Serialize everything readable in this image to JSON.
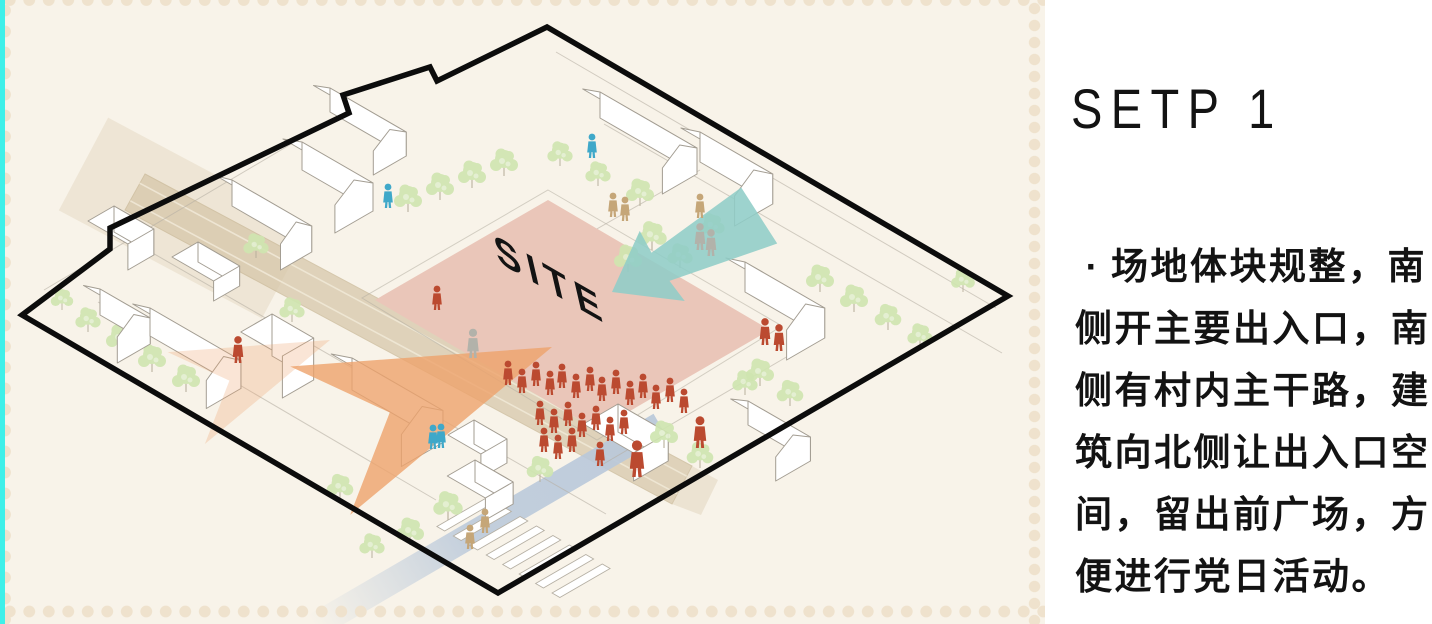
{
  "colors": {
    "cyan-strip": "#3ff0e9",
    "panel-cream": "#f8f3e9",
    "dot": "#efe2cd",
    "ink": "#131313",
    "boundary-black": "#0c0c0c",
    "site-pink": "#eac6b9",
    "arrow-teal": "#8fcdc7",
    "arrow-orange": "#eda26b",
    "road-tan": "#d6c6a8",
    "road-blue": "#b9c8da",
    "tree-green": "#cfe5b0",
    "building-line": "#a39d92",
    "street-line": "#b5afa3",
    "person-red": "#bb4a30",
    "person-blue": "#3fa8c9",
    "person-tan": "#c5a678",
    "person-gray": "#b2b2aa"
  },
  "step_panel": {
    "title": "SETP 1",
    "bullet": "·",
    "lines": [
      "场地体块规整，南",
      "侧开主要出入口，南",
      "侧有村内主干路，建",
      "筑向北侧让出入口空",
      "间，留出前广场，方",
      "便进行党日活动。"
    ]
  },
  "illustration": {
    "site_label": "SITE",
    "site_label_transform": "matrix(0.87,0.5,0.22,0.95,498,262)",
    "boundary": "547,27 1008,296 498,593 22,315 110,249 110,228 349,113 343,95 430,67 437,81",
    "site_block": "548,200 770,330 597,430 375,300",
    "sidewalk": "548,190 782,326 597,440 362,298",
    "roads": {
      "tan_band": "145,174 692,466 672,504 125,210",
      "tan_head": {
        "x": 185,
        "y": 218,
        "w": 230,
        "h": 105,
        "rot": 28
      },
      "tan_exit": "692,466 718,480 701,515 672,504",
      "lanes": [
        [
          139.7,
          183.2,
          686.7,
          476.2
        ],
        [
          130.3,
          200.8,
          677.3,
          493.8
        ]
      ],
      "blue_band": "653.5,413.8 666.5,436.2 320.9,637.4 307.9,615",
      "blue_grad": {
        "x1": 660,
        "y1": 425,
        "x2": 314,
        "y2": 626
      }
    },
    "streets": [
      [
        556,
        52,
        996,
        308
      ],
      [
        352,
        108,
        44,
        290
      ],
      [
        130,
        240,
        606,
        514
      ],
      [
        98,
        302,
        436,
        500
      ],
      [
        604,
        124,
        1002,
        353
      ],
      [
        700,
        170,
        560,
        250
      ],
      [
        795,
        352,
        600,
        466
      ]
    ],
    "crosswalk": {
      "x": 462,
      "y": 512,
      "count": 8,
      "step": 19,
      "w": 9,
      "len": 58
    },
    "buildings": [
      [
        330,
        112,
        88,
        38,
        24,
        12
      ],
      [
        600,
        118,
        112,
        40,
        26,
        13
      ],
      [
        700,
        162,
        84,
        44,
        30,
        15
      ],
      [
        302,
        170,
        82,
        44,
        28,
        14
      ],
      [
        232,
        206,
        92,
        36,
        26,
        13
      ],
      [
        114,
        232,
        46,
        30,
        26,
        0
      ],
      [
        198,
        262,
        48,
        30,
        20,
        0
      ],
      [
        745,
        292,
        92,
        44,
        30,
        15
      ],
      [
        100,
        315,
        58,
        38,
        26,
        13
      ],
      [
        150,
        336,
        105,
        40,
        28,
        14
      ],
      [
        272,
        356,
        48,
        36,
        42,
        0
      ],
      [
        352,
        390,
        105,
        48,
        32,
        16
      ],
      [
        748,
        425,
        72,
        40,
        24,
        12
      ],
      [
        618,
        432,
        58,
        40,
        28,
        0
      ],
      [
        474,
        444,
        38,
        30,
        24,
        0
      ],
      [
        475,
        482,
        44,
        32,
        22,
        0
      ]
    ],
    "trees_back": [
      [
        408,
        212,
        1
      ],
      [
        440,
        200,
        1
      ],
      [
        472,
        188,
        1
      ],
      [
        504,
        176,
        1
      ],
      [
        560,
        166,
        0.9
      ],
      [
        598,
        186,
        0.9
      ],
      [
        640,
        206,
        1
      ],
      [
        652,
        250,
        1.05
      ],
      [
        628,
        272,
        1
      ],
      [
        680,
        268,
        0.9
      ],
      [
        712,
        238,
        0.9
      ],
      [
        820,
        292,
        1
      ],
      [
        854,
        312,
        1
      ],
      [
        888,
        330,
        0.95
      ],
      [
        920,
        348,
        0.9
      ],
      [
        963,
        292,
        0.85
      ],
      [
        760,
        386,
        1
      ],
      [
        790,
        406,
        0.95
      ],
      [
        88,
        332,
        0.9
      ],
      [
        120,
        352,
        1
      ],
      [
        152,
        372,
        1
      ],
      [
        186,
        392,
        1
      ],
      [
        62,
        310,
        0.8
      ],
      [
        256,
        258,
        0.9
      ],
      [
        292,
        322,
        0.9
      ],
      [
        340,
        500,
        0.95
      ],
      [
        372,
        558,
        0.9
      ]
    ],
    "trees_front": [
      [
        448,
        520,
        1.05
      ],
      [
        410,
        545,
        1
      ],
      [
        664,
        448,
        1
      ],
      [
        700,
        468,
        0.95
      ],
      [
        745,
        395,
        0.9
      ],
      [
        540,
        482,
        0.95
      ]
    ],
    "arrows": {
      "teal": {
        "points": "0,0 -58,-45 -56,-18 -170,-36 -170,36 -56,18 -58,45",
        "transform": "translate(612,292) scale(1,0.9) rotate(150)"
      },
      "orange": {
        "points": "0,0 -250,-80 -175,0 -250,80",
        "transform": "translate(552,347) rotate(-22)",
        "opacity": 0.8
      },
      "orange_faint": {
        "points": "0,0 -250,-80 -175,0 -250,80",
        "transform": "translate(330,340) rotate(-22) scale(0.62)",
        "opacity": 0.28
      }
    },
    "people": [
      {
        "c": "person-blue",
        "p": [
          [
            592,
            158,
            1
          ],
          [
            388,
            208,
            1
          ],
          [
            433,
            449,
            1
          ],
          [
            441,
            448,
            1
          ]
        ]
      },
      {
        "c": "person-tan",
        "p": [
          [
            613,
            217,
            1
          ],
          [
            625,
            221,
            1
          ],
          [
            700,
            218,
            1
          ],
          [
            470,
            549,
            1
          ],
          [
            485,
            533,
            1
          ]
        ]
      },
      {
        "c": "person-gray",
        "p": [
          [
            700,
            250,
            1.1
          ],
          [
            711,
            256,
            1.1
          ],
          [
            473,
            358,
            1.2
          ]
        ]
      },
      {
        "c": "person-red",
        "p": [
          [
            238,
            363,
            1.1
          ],
          [
            437,
            310,
            1
          ],
          [
            765,
            345,
            1.1
          ],
          [
            779,
            351,
            1.1
          ]
        ]
      }
    ],
    "crowd": [
      [
        508,
        385
      ],
      [
        522,
        393
      ],
      [
        536,
        386
      ],
      [
        550,
        395
      ],
      [
        562,
        388
      ],
      [
        576,
        398
      ],
      [
        590,
        391
      ],
      [
        602,
        401
      ],
      [
        616,
        394
      ],
      [
        630,
        405
      ],
      [
        643,
        398
      ],
      [
        656,
        409
      ],
      [
        670,
        402
      ],
      [
        684,
        413
      ],
      [
        540,
        425
      ],
      [
        554,
        433
      ],
      [
        568,
        426
      ],
      [
        582,
        437
      ],
      [
        596,
        430
      ],
      [
        610,
        441
      ],
      [
        624,
        434
      ],
      [
        544,
        452
      ],
      [
        558,
        459
      ],
      [
        572,
        452
      ],
      [
        600,
        466
      ]
    ],
    "big_people": [
      [
        637,
        477,
        1.5
      ],
      [
        700,
        448,
        1.3
      ]
    ]
  }
}
